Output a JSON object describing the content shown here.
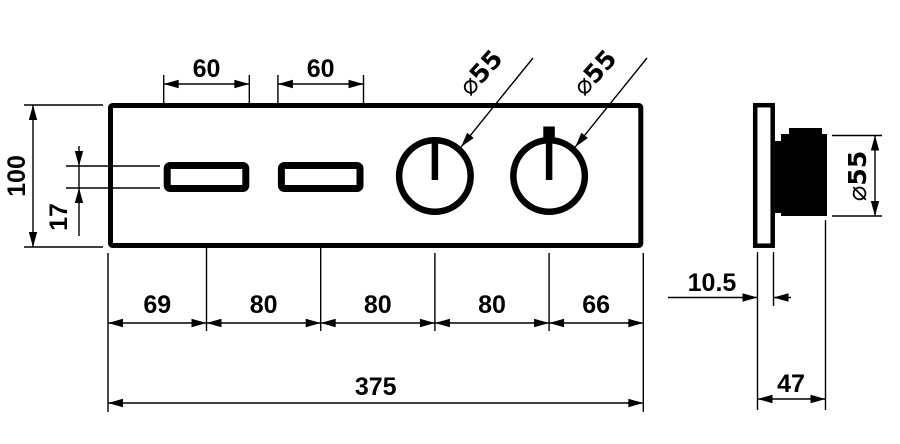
{
  "drawing": {
    "title": "panel-dimension-drawing",
    "front_view": {
      "overall_width": "375",
      "overall_height": "100",
      "slot_width": "60",
      "slot_height": "17",
      "diameter_symbol": "⌀",
      "diameter_value": "55",
      "bottom_chain": [
        "69",
        "80",
        "80",
        "80",
        "66"
      ]
    },
    "side_view": {
      "plate_thickness": "10.5",
      "total_depth": "47",
      "diameter_symbol": "⌀",
      "diameter_value": "55"
    }
  }
}
